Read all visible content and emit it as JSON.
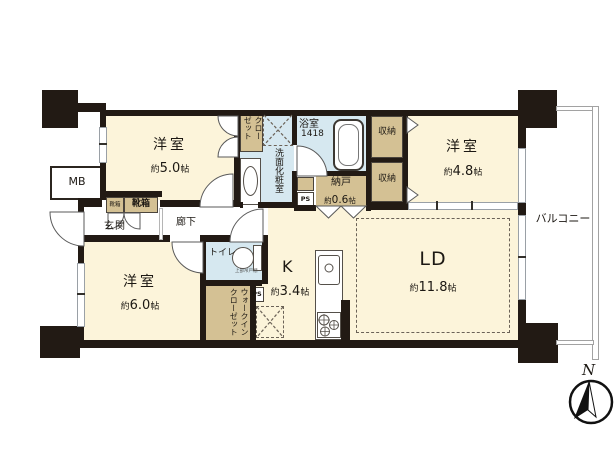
{
  "rooms": {
    "bedroom_small": {
      "name": "洋室",
      "size_prefix": "約",
      "size_value": "5.0",
      "size_unit": "帖"
    },
    "bedroom_right": {
      "name": "洋室",
      "size_prefix": "約",
      "size_value": "4.8",
      "size_unit": "帖"
    },
    "bedroom_main": {
      "name": "洋室",
      "size_prefix": "約",
      "size_value": "6.0",
      "size_unit": "帖"
    },
    "living_dining": {
      "name": "LD",
      "size_prefix": "約",
      "size_value": "11.8",
      "size_unit": "帖"
    },
    "kitchen": {
      "name": "K",
      "size_prefix": "約",
      "size_value": "3.4",
      "size_unit": "帖"
    },
    "storage_room": {
      "name": "納戸",
      "size_prefix": "約",
      "size_value": "0.6",
      "size_unit": "帖"
    },
    "bathroom": {
      "name": "浴室",
      "size_code": "1418"
    },
    "washroom": {
      "name": "洗面化粧室"
    },
    "toilet": {
      "name": "トイレ",
      "shelf_note": "上部吊戸棚"
    },
    "entrance": {
      "name": "玄関"
    },
    "hallway": {
      "name": "廊下"
    },
    "balcony": {
      "name": "バルコニー"
    },
    "closet": {
      "name": "クローゼット"
    },
    "walk_in_closet": {
      "name": "ウォークインクローゼット"
    },
    "storage_upper": {
      "name": "収納"
    },
    "storage_lower": {
      "name": "収納"
    },
    "shoe_box_small": {
      "name": "靴箱"
    },
    "shoe_box_large": {
      "name": "靴箱"
    }
  },
  "annotations": {
    "meter_box": "MB",
    "pipe_space_1": "PS",
    "pipe_space_2": "PS",
    "compass_north": "N"
  },
  "colors": {
    "wall": "#221a14",
    "room_cream": "#fcf4da",
    "storage_tan": "#d4c194",
    "wet_blue": "#d6e8f0",
    "outline": "#5a5a5a"
  }
}
